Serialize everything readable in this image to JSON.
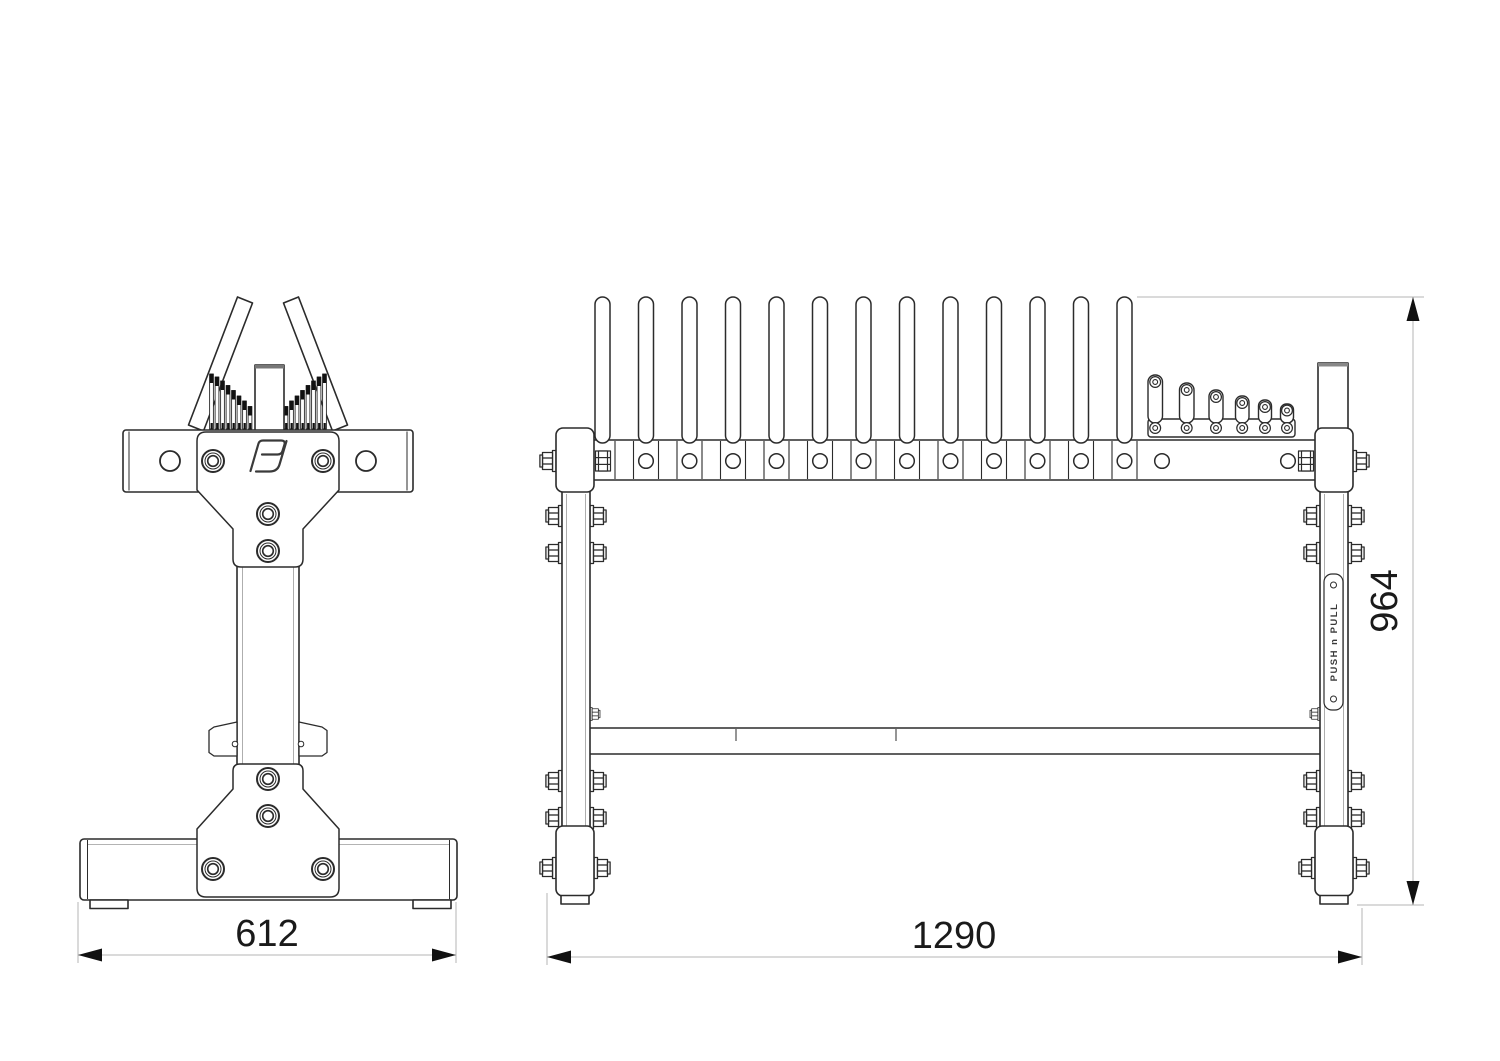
{
  "drawing": {
    "type": "technical-dimension-drawing",
    "subject": "weight plate storage rack",
    "views": {
      "side_view": "left",
      "front_view": "right"
    },
    "dimensions": {
      "side_width": "612",
      "front_width": "1290",
      "front_height": "964"
    },
    "brand_plate_text": "PUSH n PULL",
    "icons": {
      "brand_monogram": "PJ-monogram"
    },
    "colors": {
      "line": "#2b2b2b",
      "thin_line": "#8a8a8a",
      "dimension_line": "#b5b5b5",
      "arrow_and_text": "#111111",
      "background": "#ffffff"
    }
  }
}
